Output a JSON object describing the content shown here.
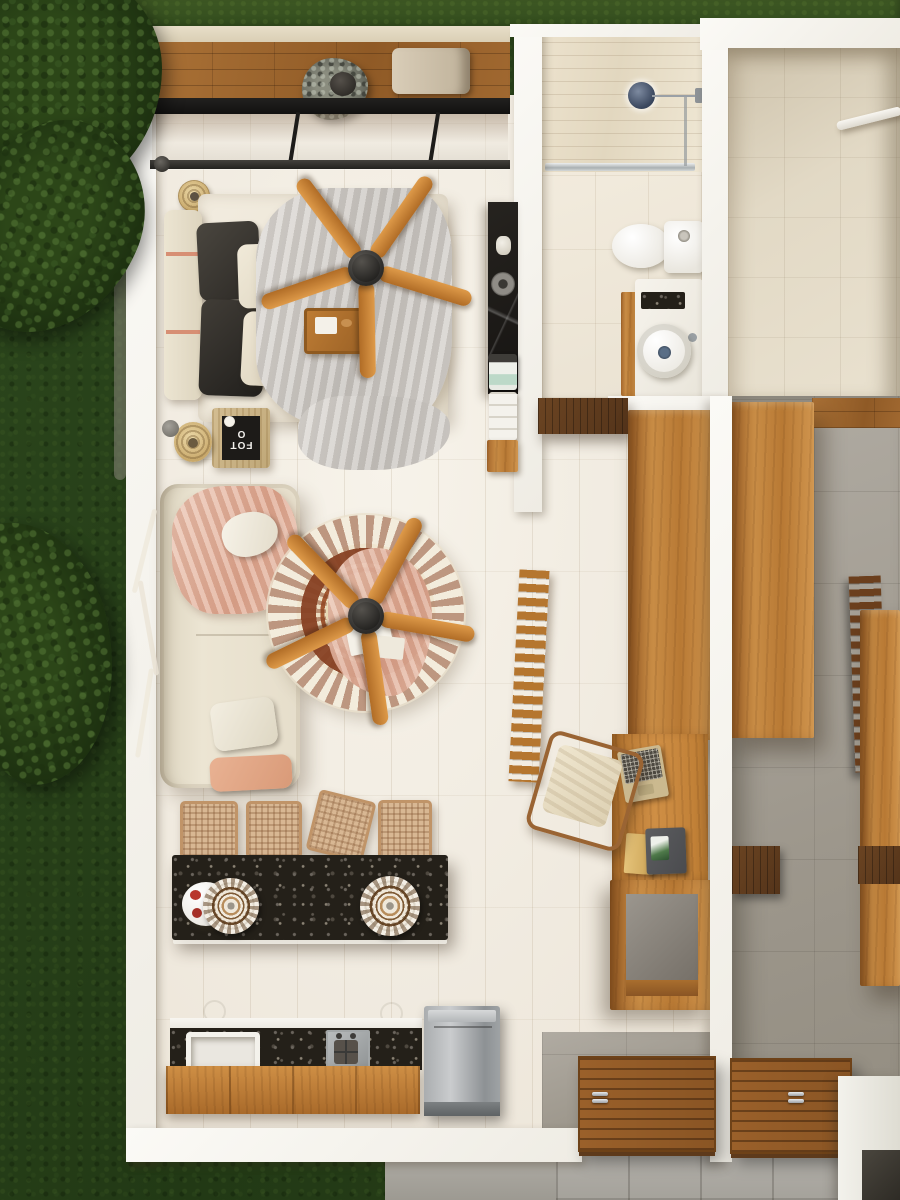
{
  "scene": {
    "title": "Top-view 3D architectural render of a studio apartment floor plan",
    "view": "top-down",
    "photo_text": "FOTO"
  },
  "palette": {
    "grass_dark": "#223915",
    "grass_top": "#3d5723",
    "foliage": "#1b2e0f",
    "path_gray": "#6f6c5f",
    "walkway_gray": "#a6a39b",
    "patio_tile": "#b0ada7",
    "wall_white": "#f7f5f0",
    "floor_cream": "#f2ede3",
    "bath_tile": "#eee7d9",
    "shower_wood": "#e8dec9",
    "entry_beige": "#ddd3bf",
    "neighbor_gray": "#a5a096",
    "wood_oak": "#c0823d",
    "wood_deck": "#9c6531",
    "wood_walnut": "#5f3b1e",
    "terrazzo_black": "#242019",
    "steel_gray": "#aeb2b4",
    "fan_wood": "#d08a3e",
    "fan_hub": "#26241f",
    "sofa_cream": "#e8e1cf",
    "throw_pink": "#e5b7a2",
    "pillow_dark": "#38342f",
    "duvet_gray": "#d6d2cd",
    "rug_red": "#8d4a2c",
    "rug_cream": "#efe5cc",
    "shower_head_slate": "#4a5668",
    "sink_drain_blue": "#5a6e86"
  },
  "outdoor": {
    "lawn": "grass lawn",
    "tree": "tree canopy",
    "path": "garden path",
    "walkway": "concrete walkway",
    "patio": "gray patio tiles"
  },
  "balcony": {
    "ledge": "stone ledge",
    "deck": "wood plank deck",
    "plant": "potted plant",
    "lounge_chair": "outdoor cushion chair",
    "sliding_door": "black-frame sliding glass door"
  },
  "bedroom": {
    "pendant_lamp": "rattan pendant lamp",
    "headboard": "upholstered headboard",
    "bed": "double bed",
    "pillows_dark": "charcoal pillows",
    "pillows_light": "cream pillows",
    "duvet": "gray duvet",
    "tray": "wood breakfast tray",
    "ceiling_fan": "five-blade wood ceiling fan",
    "side_table": "rattan side table",
    "photo_book": {
      "text": "FOTO"
    },
    "basket_shade": "woven basket shade",
    "orb": "gray decor ball"
  },
  "kitchenette": {
    "counter": "black marble wall counter",
    "sink": "round steel sink",
    "dispenser": "countertop appliance",
    "towels": "towel stack",
    "base": "oak base cabinet"
  },
  "bathroom": {
    "shower": "walk-in shower",
    "shower_head": "wall shower head",
    "glass_screen": "glass shower screen",
    "toilet": "toilet with cistern",
    "vanity": "oak vanity",
    "vanity_tray": "stone tray",
    "sink": "round vessel sink",
    "bench": "walnut doorway bench"
  },
  "entry": {
    "hall": "entry hall",
    "shelf": "white wall shelf",
    "threshold": "wood threshold deck"
  },
  "living": {
    "sofa": "cream fabric sofa",
    "throw": "rose throw blanket",
    "pillow_white": "white pillow",
    "pillow_pink": "rose pillow",
    "branch": "dried branch decor",
    "rug": "round oriental rug",
    "ceiling_fan": "five-blade wood ceiling fan",
    "rug_throw": "rose blanket",
    "papers": "white magazines"
  },
  "dining": {
    "chairs": [
      "woven dining chair",
      "woven dining chair",
      "woven dining chair",
      "woven dining chair"
    ],
    "table": "black terrazzo dining table",
    "plate_left": "ornate place setting",
    "plate_right": "ornate place setting",
    "fruit_plate": "fruit plate"
  },
  "kitchen": {
    "counter_edge": "white counter edge",
    "counter": "terrazzo counter with backsplash",
    "sink": "farmhouse sink",
    "cooktop": "built-in cooktop",
    "cabinets": "oak cabinet fronts",
    "fridge": "stainless refrigerator",
    "wall_motifs": "circle tile motifs"
  },
  "study": {
    "ladder_rack": "wood ladder rack",
    "desk_chair": "wood-frame desk chair",
    "desk": "built-in oak desk",
    "laptop": "open laptop",
    "books": "books and tablet",
    "cube_shelf": "open storage cube",
    "wardrobe_west": "oak wardrobe",
    "wardrobe_east": "oak wardrobe",
    "divider_wall": "white partition wall",
    "wall_cabinet_west": "walnut wall cabinet",
    "wall_cabinet_east": "walnut wall cabinet"
  },
  "entrance": {
    "door_west": "slatted wood entry door",
    "door_east": "slatted wood entry door",
    "handle": "steel pull handles",
    "planter": "white planter bench",
    "planter_niche": "dark niche"
  },
  "neighbor": {
    "floor": "adjacent unit gray floor",
    "ladder_rack": "wood ladder rack",
    "wardrobe": "oak wardrobe",
    "threshold": "wood deck strip"
  }
}
